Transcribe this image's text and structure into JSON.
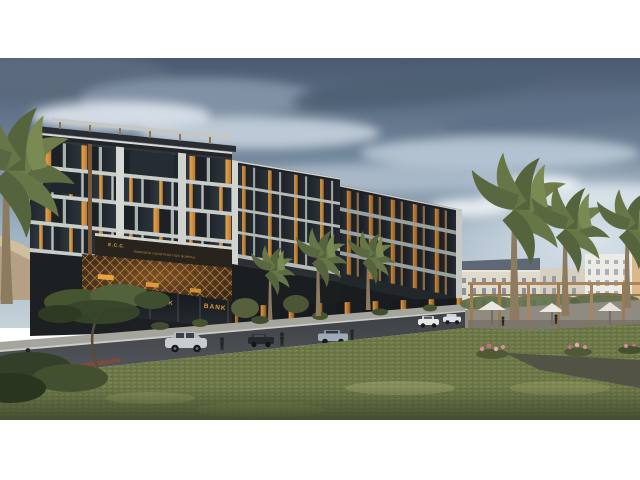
{
  "scene": {
    "type": "architectural-exterior-rendering",
    "description": "Twilight 3D rendering of a modern mixed-use residential building with ground-floor bank branches, palm-lined street, desert mountains, classical buildings and a pergola plaza",
    "signs": {
      "ecc_abbr": "E.C.C.",
      "ecc_name": "EMERSON CONSTRUCTION BUREAU",
      "bank_left": "BANK",
      "bank_right": "BANK"
    },
    "palette": {
      "sky_top": "#4a5a70",
      "sky_horizon": "#c6d2d9",
      "cloud_dark": "#4e5f73",
      "cloud_light": "#e8eef3",
      "mountain": "#e0d0b4",
      "facade_dark": "#2e3338",
      "facade_band": "#c9cdc9",
      "window_lit": "#e2a24c",
      "sign_amber": "#d89a3e",
      "glass": "#27303a",
      "street": "#45494d",
      "sidewalk": "#a6a59d",
      "grass": "#6b7747",
      "palm_frond": "#5d6b42",
      "palm_trunk": "#8d7b60",
      "pergola_wood": "#a8845f",
      "umbrella": "#e9e7e0",
      "classical_building": "#e0dacb",
      "flower_pink": "#d98aa0"
    }
  }
}
